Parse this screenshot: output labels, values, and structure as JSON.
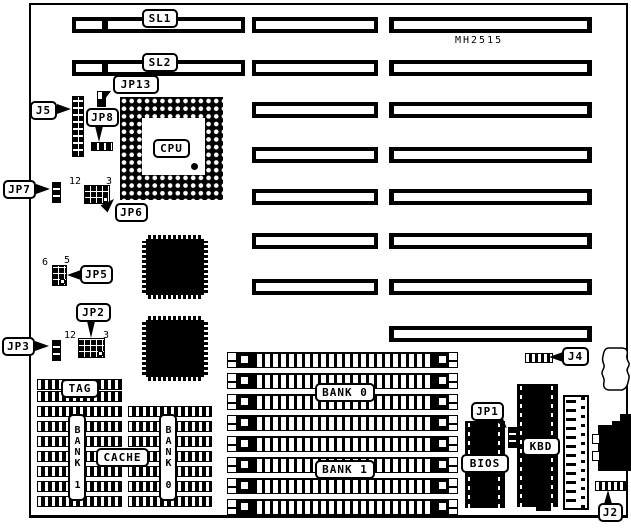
{
  "diagram": {
    "model_number": "MH2515",
    "line_color": "#000000",
    "background_color": "#ffffff"
  },
  "slots": {
    "sl1_label": "SL1",
    "sl2_label": "SL2"
  },
  "cpu_label": "CPU",
  "jumpers": {
    "jp13": "JP13",
    "jp8": "JP8",
    "jp7": "JP7",
    "jp6": "JP6",
    "jp5": "JP5",
    "jp3": "JP3",
    "jp2": "JP2",
    "jp1": "JP1"
  },
  "connectors": {
    "j5": "J5",
    "j4": "J4",
    "j2": "J2"
  },
  "pin_labels": {
    "jp6_pin12": "12",
    "jp6_pin3": "3",
    "jp2_pin12": "12",
    "jp2_pin3": "3",
    "jp5_pin6": "6",
    "jp5_pin5": "5"
  },
  "cache": {
    "tag_label": "TAG",
    "cache_label": "CACHE",
    "bank0_label": "BANK 0",
    "bank1_label": "BANK 1"
  },
  "memory": {
    "bank0_label": "BANK 0",
    "bank1_label": "BANK 1"
  },
  "chips": {
    "bios_label": "BIOS",
    "kbd_label": "KBD"
  }
}
